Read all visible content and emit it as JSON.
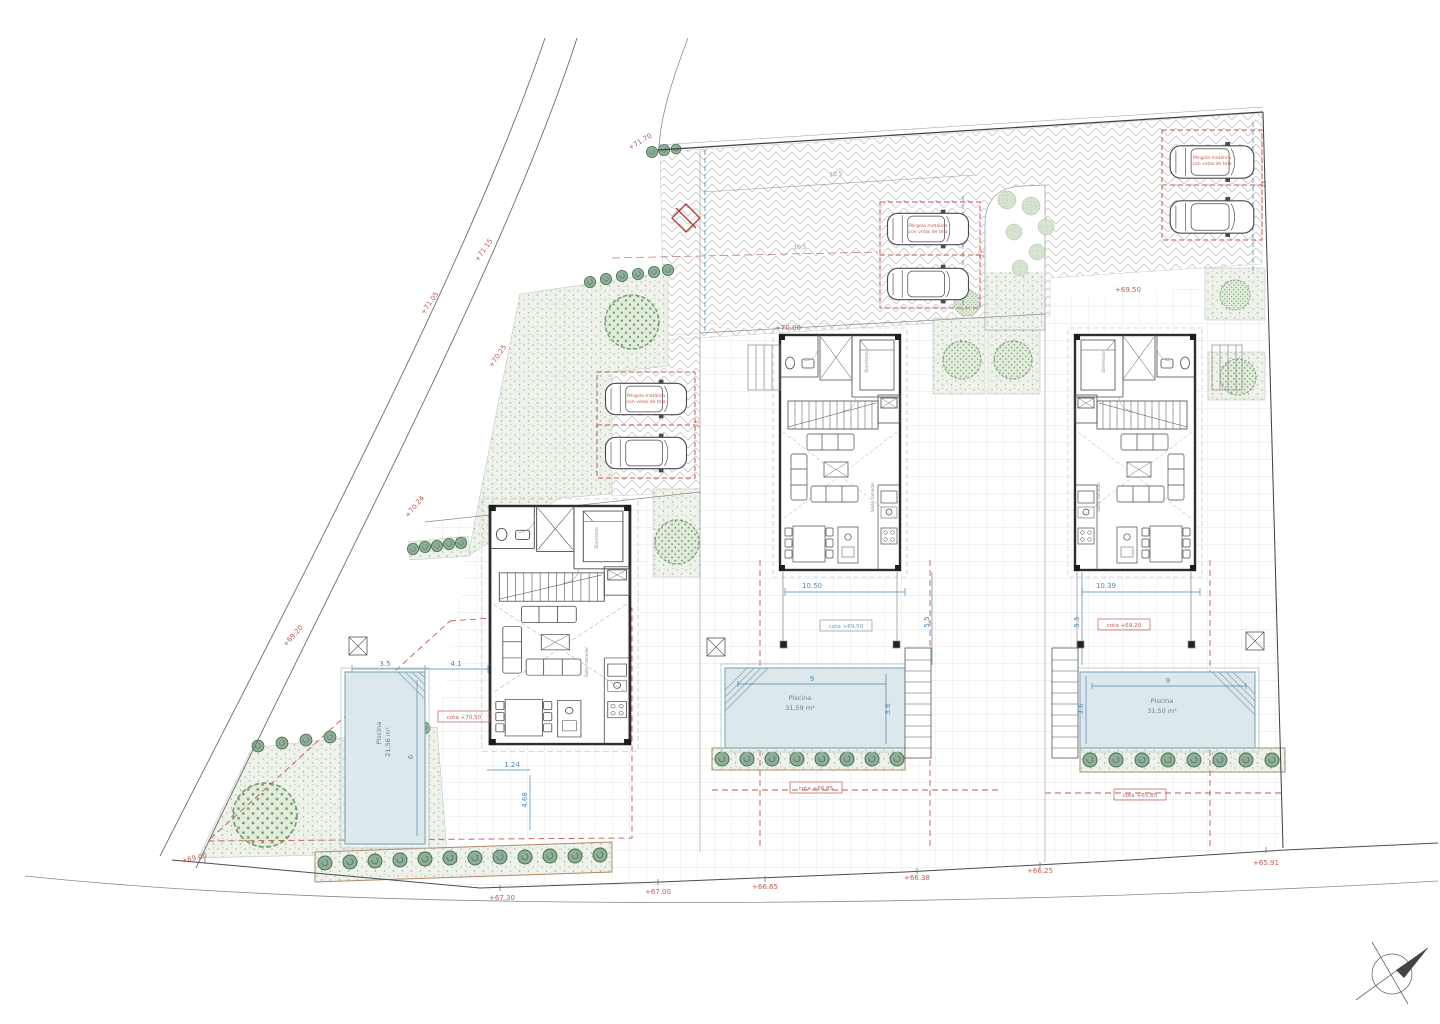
{
  "plan": {
    "road_elevations": [
      "+71.70",
      "+71.15",
      "+71.05",
      "+70.25",
      "+70.24",
      "+69.20",
      "+69.00",
      "+67.30",
      "+67.00",
      "+66.65",
      "+66.38",
      "+66.25",
      "+65.91"
    ],
    "garden_elevations": [
      "+70.00",
      "+69.50"
    ],
    "pergola": {
      "line1": "Pérgola metálica",
      "line2": "con velas de tela"
    },
    "pools": {
      "left": {
        "label": "Piscina",
        "area": "21,56 m²"
      },
      "middle": {
        "label": "Piscina",
        "area": "31,59 m²"
      },
      "right": {
        "label": "Piscina",
        "area": "31,50 m²"
      }
    },
    "cotas": {
      "left": "cota +70,50",
      "middle": "cota +69,50",
      "right": "cota +69,20",
      "street_middle": "cota +66,85",
      "street_right": "cota +65,85"
    },
    "dimensions": {
      "pool_len_m": "9",
      "pool_wid_m": "3.6",
      "pool_len_r": "9",
      "pool_wid_r": "3.6",
      "pool_len_l": "6",
      "pool_wid_l": "3.5",
      "terrace_l": "4.1",
      "step_l": "1.24",
      "side_l": "4.68",
      "plot_m": "10.50",
      "plot_r": "10.39",
      "gap_m": "5.5",
      "gap_r": "5.5",
      "drive_a": "10.5",
      "drive_b": "10.5",
      "park_l": "3.5",
      "park_m": "3.5",
      "park_r": "3.5"
    },
    "rooms": {
      "bedroom": "Dormitorio",
      "living": "Salón comedor"
    },
    "colors": {
      "red": "#bf5b52",
      "blue": "#4f89ad",
      "green": "#6f9b6f"
    }
  }
}
